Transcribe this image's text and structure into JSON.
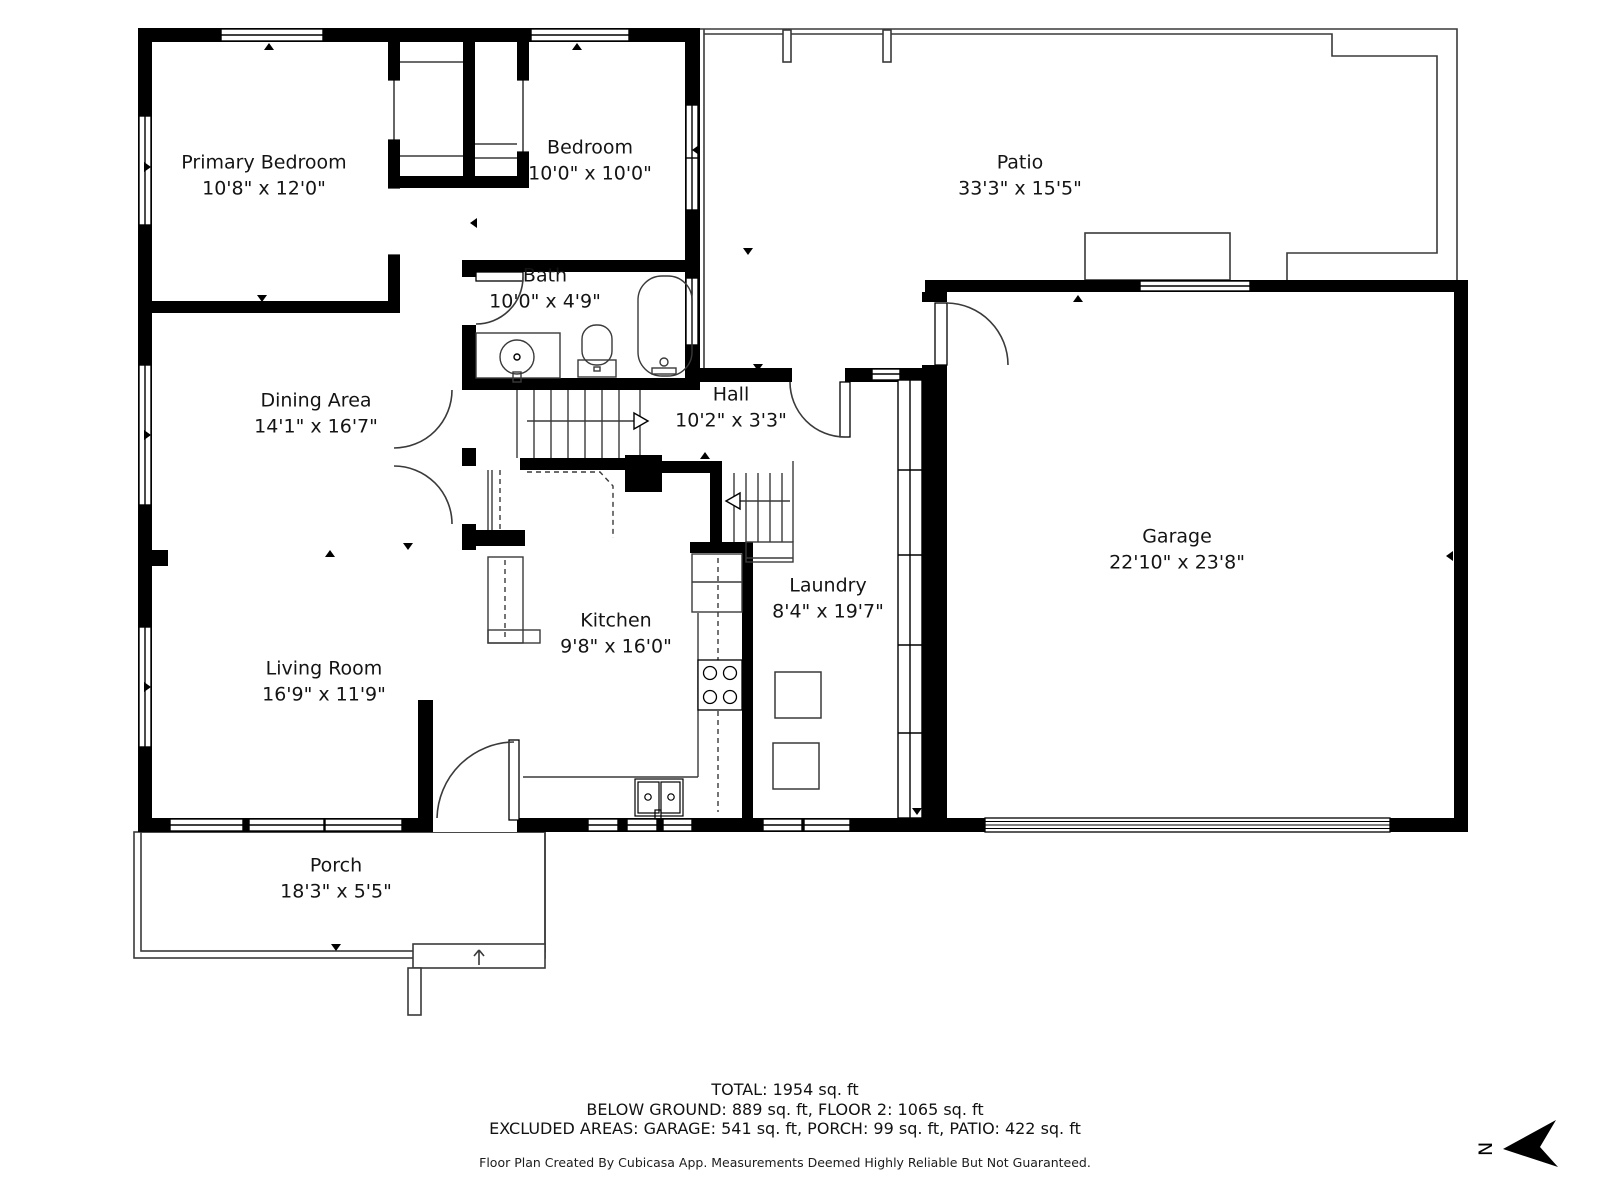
{
  "floorplan": {
    "rooms": [
      {
        "name": "Primary Bedroom",
        "dims": "10'8\" x 12'0\""
      },
      {
        "name": "Bedroom",
        "dims": "10'0\" x 10'0\""
      },
      {
        "name": "Bath",
        "dims": "10'0\" x 4'9\""
      },
      {
        "name": "Patio",
        "dims": "33'3\" x 15'5\""
      },
      {
        "name": "Dining Area",
        "dims": "14'1\" x 16'7\""
      },
      {
        "name": "Hall",
        "dims": "10'2\" x 3'3\""
      },
      {
        "name": "Garage",
        "dims": "22'10\" x 23'8\""
      },
      {
        "name": "Kitchen",
        "dims": "9'8\" x 16'0\""
      },
      {
        "name": "Laundry",
        "dims": "8'4\" x 19'7\""
      },
      {
        "name": "Living Room",
        "dims": "16'9\" x 11'9\""
      },
      {
        "name": "Porch",
        "dims": "18'3\" x 5'5\""
      }
    ],
    "compass_label": "N"
  },
  "footer": {
    "line1": "TOTAL: 1954 sq. ft",
    "line2": "BELOW GROUND: 889 sq. ft, FLOOR 2: 1065 sq. ft",
    "line3": "EXCLUDED AREAS: GARAGE: 541 sq. ft, PORCH: 99 sq. ft, PATIO: 422 sq. ft",
    "disclaimer": "Floor Plan Created By Cubicasa App. Measurements Deemed Highly Reliable But Not Guaranteed."
  },
  "colors": {
    "wall": "#000000",
    "line": "#3a3a3a",
    "background": "#ffffff"
  }
}
